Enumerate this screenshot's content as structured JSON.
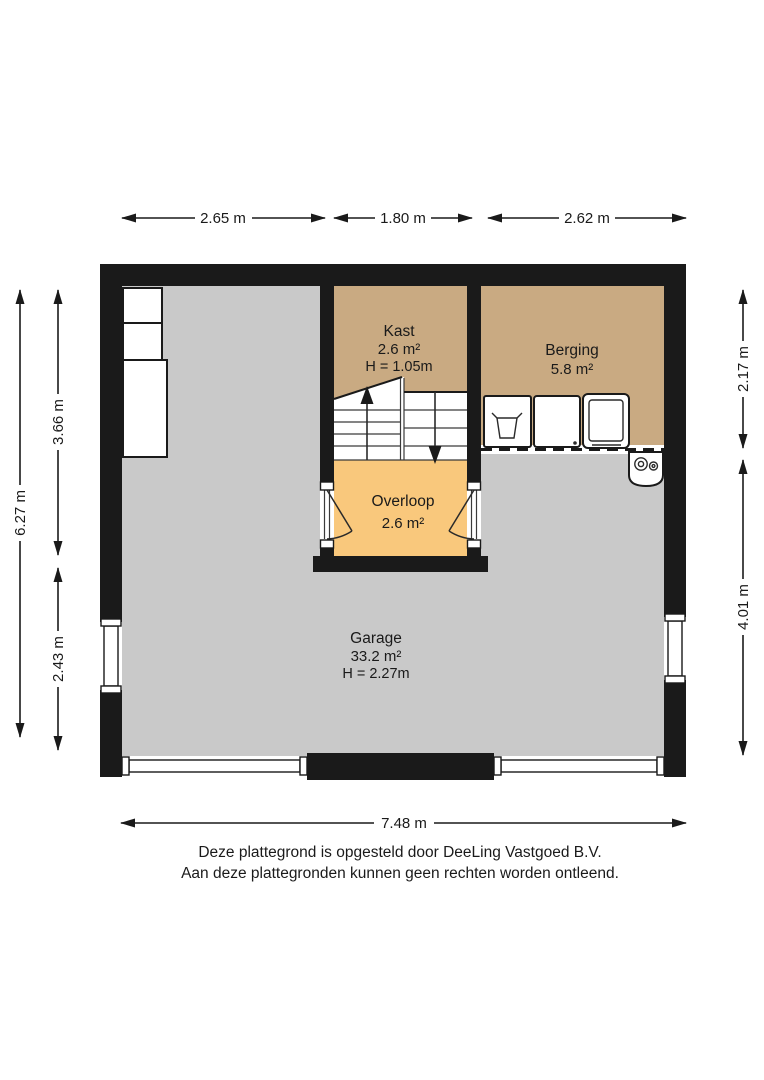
{
  "colors": {
    "wall": "#1a1a1a",
    "garage_floor": "#c9c9c9",
    "kast_floor": "#c9aa82",
    "berging_floor": "#c9aa82",
    "overloop_floor": "#f9c87c"
  },
  "dimensions": {
    "top_left": "2.65 m",
    "top_middle": "1.80 m",
    "top_right": "2.62 m",
    "left_total": "6.27 m",
    "left_upper": "3.66 m",
    "left_lower": "2.43 m",
    "right_upper": "2.17 m",
    "right_lower": "4.01 m",
    "bottom": "7.48 m"
  },
  "rooms": {
    "kast": {
      "name": "Kast",
      "area": "2.6 m²",
      "height": "H = 1.05m"
    },
    "berging": {
      "name": "Berging",
      "area": "5.8 m²"
    },
    "overloop": {
      "name": "Overloop",
      "area": "2.6 m²"
    },
    "garage": {
      "name": "Garage",
      "area": "33.2 m²",
      "height": "H = 2.27m"
    }
  },
  "footer": {
    "line1": "Deze plattegrond is opgesteld door DeeLing Vastgoed B.V.",
    "line2": "Aan deze plattegronden kunnen geen rechten worden ontleend."
  }
}
